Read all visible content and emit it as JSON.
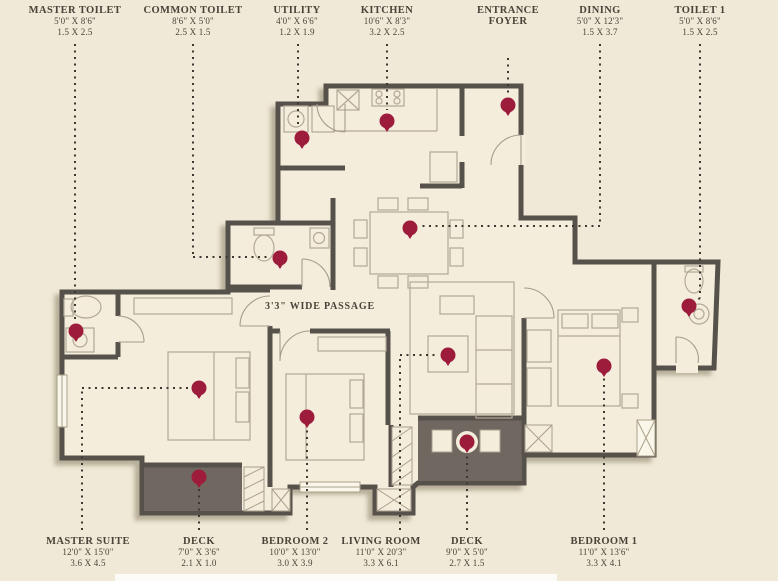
{
  "colors": {
    "background": "#F0E9D7",
    "wall": "#57514B",
    "deck_fill": "#6F6860",
    "marker": "#9D1C3B",
    "label_text": "#4A4339"
  },
  "passage_label": "3'3\" WIDE PASSAGE",
  "top_labels": [
    {
      "room": "MASTER TOILET",
      "feet": "5'0\" X 8'6\"",
      "meters": "1.5 X 2.5"
    },
    {
      "room": "COMMON TOILET",
      "feet": "8'6\" X 5'0\"",
      "meters": "2.5 X 1.5"
    },
    {
      "room": "UTILITY",
      "feet": "4'0\" X 6'6\"",
      "meters": "1.2 X 1.9"
    },
    {
      "room": "KITCHEN",
      "feet": "10'6\" X 8'3\"",
      "meters": "3.2 X 2.5"
    },
    {
      "room": "ENTRANCE FOYER",
      "feet": "",
      "meters": ""
    },
    {
      "room": "DINING",
      "feet": "5'0\" X 12'3\"",
      "meters": "1.5 X 3.7"
    },
    {
      "room": "TOILET 1",
      "feet": "5'0\" X 8'6\"",
      "meters": "1.5 X 2.5"
    }
  ],
  "bottom_labels": [
    {
      "room": "MASTER SUITE",
      "feet": "12'0\" X 15'0\"",
      "meters": "3.6 X 4.5"
    },
    {
      "room": "DECK",
      "feet": "7'0\" X 3'6\"",
      "meters": "2.1 X 1.0"
    },
    {
      "room": "BEDROOM 2",
      "feet": "10'0\" X 13'0\"",
      "meters": "3.0 X 3.9"
    },
    {
      "room": "LIVING ROOM",
      "feet": "11'0\" X 20'3\"",
      "meters": "3.3 X 6.1"
    },
    {
      "room": "DECK",
      "feet": "9'0\" X 5'0\"",
      "meters": "2.7 X 1.5"
    },
    {
      "room": "BEDROOM 1",
      "feet": "11'0\" X 13'6\"",
      "meters": "3.3 X 4.1"
    }
  ]
}
